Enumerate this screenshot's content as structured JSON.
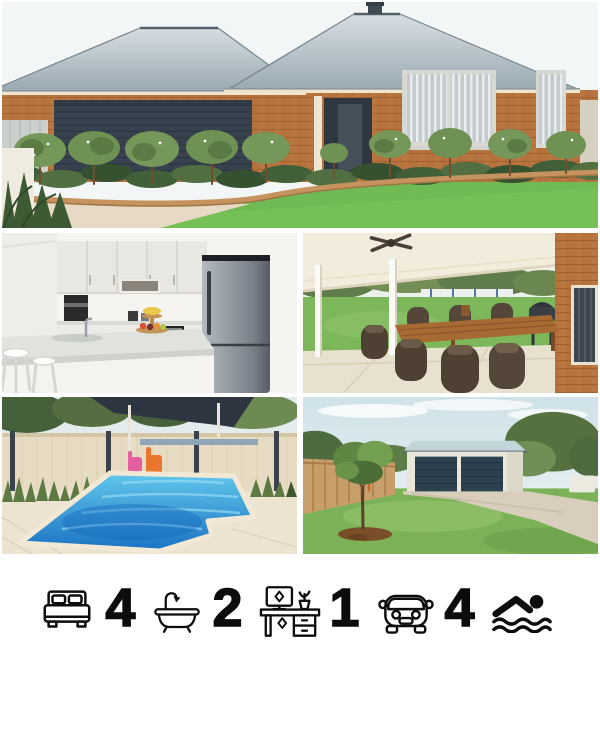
{
  "stats": [
    {
      "name": "bedrooms",
      "icon": "bed-icon",
      "value": "4"
    },
    {
      "name": "bathrooms",
      "icon": "bathtub-icon",
      "value": "2"
    },
    {
      "name": "study",
      "icon": "desk-icon",
      "value": "1"
    },
    {
      "name": "car-spaces",
      "icon": "car-icon",
      "value": "4"
    },
    {
      "name": "pool",
      "icon": "swimmer-icon",
      "value": ""
    }
  ],
  "palette": {
    "background": "#ffffff",
    "icon_color": "#0d0d0d",
    "lawn_green": "#6fba52",
    "pool_blue": "#2488d0",
    "brick_orange": "#b6723c",
    "roof_grey": "#aebcc4",
    "shed_door_navy": "#2d4150",
    "paving_cream": "#ece3d0"
  }
}
